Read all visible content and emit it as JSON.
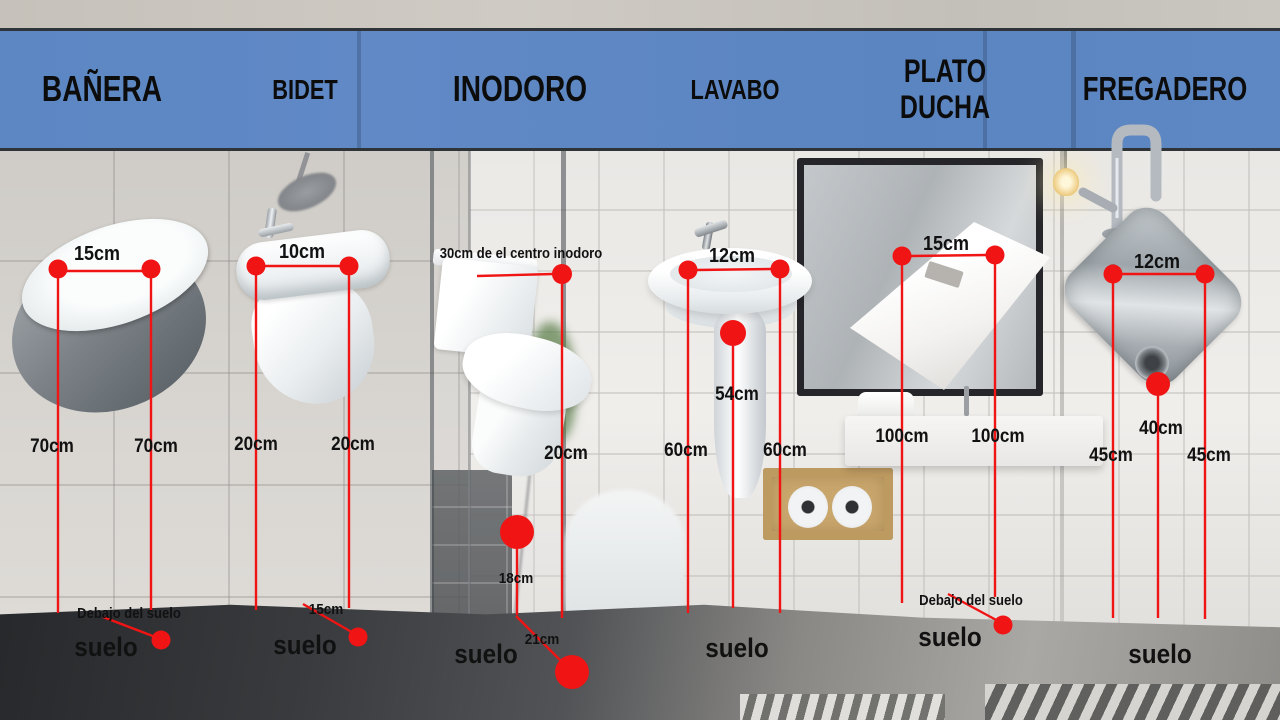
{
  "colors": {
    "band_blue": "#5d88c4",
    "accent_red": "#f01414",
    "band_border": "#2f3439"
  },
  "header": {
    "items": [
      {
        "label": "BAÑERA"
      },
      {
        "label": "BIDET"
      },
      {
        "label": "INODORO"
      },
      {
        "label": "LAVABO"
      },
      {
        "label": "PLATO DUCHA"
      },
      {
        "label": "FREGADERO"
      }
    ]
  },
  "fixtures": {
    "banera": {
      "width": "15cm",
      "left_height": "70cm",
      "right_height": "70cm",
      "below_floor_note": "Debajo del suelo",
      "floor_label": "suelo"
    },
    "bidet": {
      "width": "10cm",
      "left_height": "20cm",
      "right_height": "20cm",
      "drain_note": "15cm",
      "floor_label": "suelo"
    },
    "inodoro": {
      "offset_note": "30cm de el centro inodoro",
      "height": "20cm",
      "water_inlet": "18cm",
      "drain_note": "21cm",
      "floor_label": "suelo"
    },
    "lavabo": {
      "width": "12cm",
      "drain_height": "54cm",
      "left_height": "60cm",
      "right_height": "60cm",
      "floor_label": "suelo"
    },
    "plato_ducha": {
      "width": "15cm",
      "left_height": "100cm",
      "right_height": "100cm",
      "below_floor_note": "Debajo del suelo",
      "floor_label": "suelo"
    },
    "fregadero": {
      "width": "12cm",
      "drain_height": "40cm",
      "left_height": "45cm",
      "right_height": "45cm",
      "floor_label": "suelo"
    }
  }
}
